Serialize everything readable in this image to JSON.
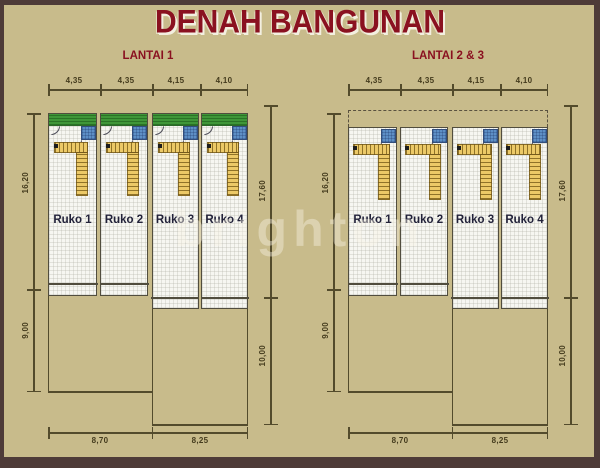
{
  "title": "DENAH BANGUNAN",
  "watermark": "brighton",
  "colors": {
    "background": "#c8bb8b",
    "frame": "#4e3b38",
    "heading": "#8a1120",
    "dimension_lines": "#534b2c",
    "unit_floor": "#f6f6f1",
    "garden_strip": "#3f9638",
    "bathroom_tile": "#5d8fc6",
    "stair_fill": "#ecc967",
    "unit_label": "#22223a"
  },
  "plans": [
    {
      "label": "LANTAI 1",
      "top_dims": [
        "4,35",
        "4,35",
        "4,15",
        "4,10"
      ],
      "left_dims": [
        "16,20",
        "9,00"
      ],
      "right_dims": [
        "17,60",
        "10,00"
      ],
      "bottom_dims": [
        "8,70",
        "8,25"
      ],
      "units": [
        "Ruko 1",
        "Ruko 2",
        "Ruko 3",
        "Ruko 4"
      ]
    },
    {
      "label": "LANTAI 2 & 3",
      "top_dims": [
        "4,35",
        "4,35",
        "4,15",
        "4,10"
      ],
      "left_dims": [
        "16,20",
        "9,00"
      ],
      "right_dims": [
        "17,60",
        "10,00"
      ],
      "bottom_dims": [
        "8,70",
        "8,25"
      ],
      "units": [
        "Ruko 1",
        "Ruko 2",
        "Ruko 3",
        "Ruko 4"
      ]
    }
  ]
}
